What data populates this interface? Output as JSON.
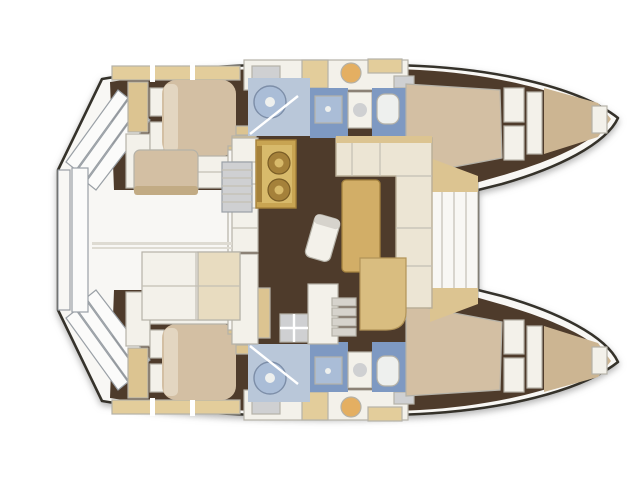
{
  "diagram": {
    "kind": "catamaran-interior-layout-plan",
    "view": "top-down",
    "hulls": 2,
    "cabins": 4,
    "heads": 4,
    "zones": {
      "bow_side": "right",
      "stern_side": "left",
      "center": "salon-with-galley-and-dinette",
      "aft_between_hulls": "cockpit",
      "fwd_between_hulls": "trampoline"
    }
  },
  "palette": {
    "background": "#ffffff",
    "hull_fill": "#f8f7f4",
    "hull_stroke": "#34302a",
    "floor_dark": "#4e3b2b",
    "deck_tan": "#dcc491",
    "locker_tan": "#e3cd9b",
    "bed_tan": "#d3bfa3",
    "bed_pillow": "#e3d6c1",
    "vberth_tan": "#ccb592",
    "cabinet_white": "#f3f1ea",
    "line_gray": "#b5b2a8",
    "shower_light": "#b9c7d9",
    "shower_medium": "#7e99c2",
    "shower_tray": "#aabdd7",
    "fixture_white": "#eef0ee",
    "stove_gold": "#c8a452",
    "stove_light": "#d8ba6b",
    "stove_dark": "#a5813a",
    "table_tan": "#d2ae67",
    "sofa_cream": "#ece5d4",
    "sofa_edge": "#b9ae97",
    "seat_tan": "#d9bd80",
    "step_gray": "#d6d3cc",
    "basin_orange": "#e4af62",
    "metal_gray": "#cfd0d2",
    "bench_edge": "#c2ab84",
    "pad_tan": "#e8dcc0",
    "seam_gray": "#dedbd2",
    "step_white": "#fbfbfa"
  }
}
